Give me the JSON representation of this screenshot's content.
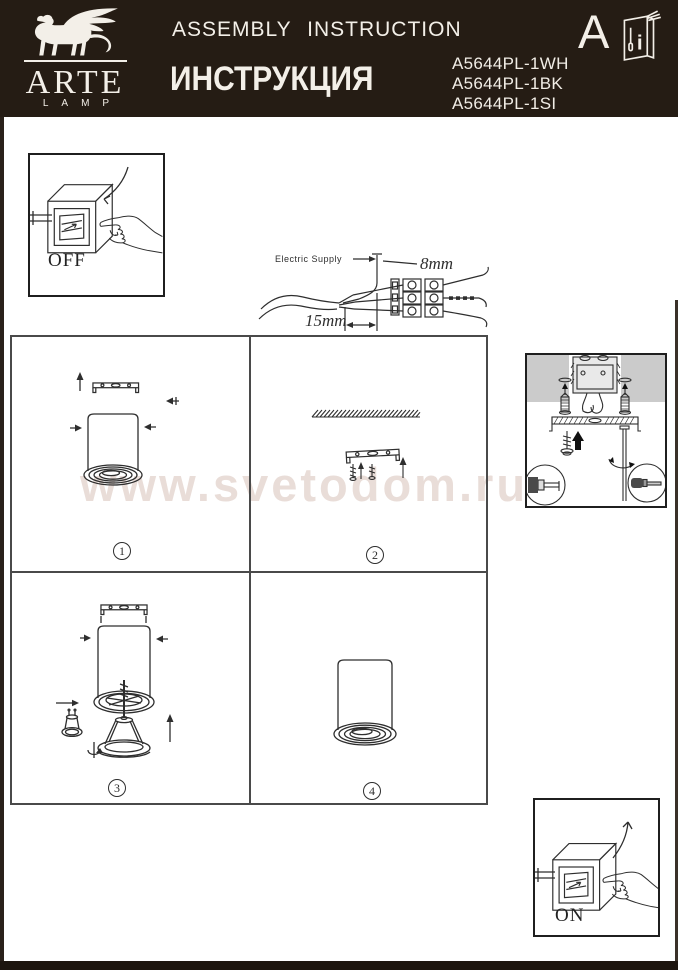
{
  "header": {
    "brand": {
      "name": "ARTE",
      "subname": "LAMP"
    },
    "title_en": "ASSEMBLY INSTRUCTION",
    "title_ru": "ИНСТРУКЦИЯ",
    "product_codes": [
      "A5644PL-1WH",
      "A5644PL-1BK",
      "A5644PL-1SI"
    ],
    "section_letter": "A",
    "manual_icon_letter": "i"
  },
  "watermark": {
    "text": "www.svetodom.ru",
    "color": "#e9ddd8"
  },
  "power": {
    "off_label": "OFF",
    "on_label": "ON"
  },
  "wiring": {
    "label": "Electric Supply",
    "strip_length_top": "8mm",
    "strip_length_bottom": "15mm"
  },
  "steps": [
    {
      "number": "1"
    },
    {
      "number": "2"
    },
    {
      "number": "3"
    },
    {
      "number": "4"
    }
  ],
  "colors": {
    "header_bg": "#251c14",
    "header_text": "#f3efe8",
    "line": "#2e2e2e",
    "grid_line": "#4a4a4a",
    "ceiling_gray": "#cbcbcb",
    "watermark": "#e9ddd8"
  }
}
